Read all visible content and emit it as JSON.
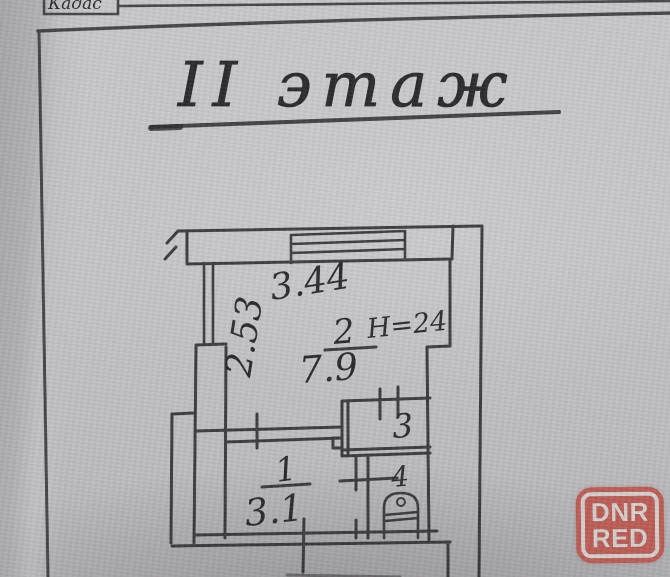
{
  "header": {
    "partial_text": "Кадас"
  },
  "title": {
    "text": "II этаж"
  },
  "plan": {
    "dimensions": {
      "width_top": "3.44",
      "height_left": "2.53"
    },
    "rooms": [
      {
        "number": "1",
        "area": "3.1"
      },
      {
        "number": "2",
        "area": "7.9",
        "height_note": "Н=24"
      },
      {
        "number": "3"
      },
      {
        "number": "4"
      }
    ],
    "features": [
      "balcony-strip",
      "window-icon",
      "toilet-icon",
      "door-opening"
    ]
  },
  "watermark": {
    "line1": "DNR",
    "line2": "RED",
    "background_color": "#bd574e",
    "text_color": "#d6d3d0"
  },
  "colors": {
    "ink": "#2b2a2e",
    "paper": "#c6c5c8",
    "paper_shadow": "#a9a8ab"
  }
}
